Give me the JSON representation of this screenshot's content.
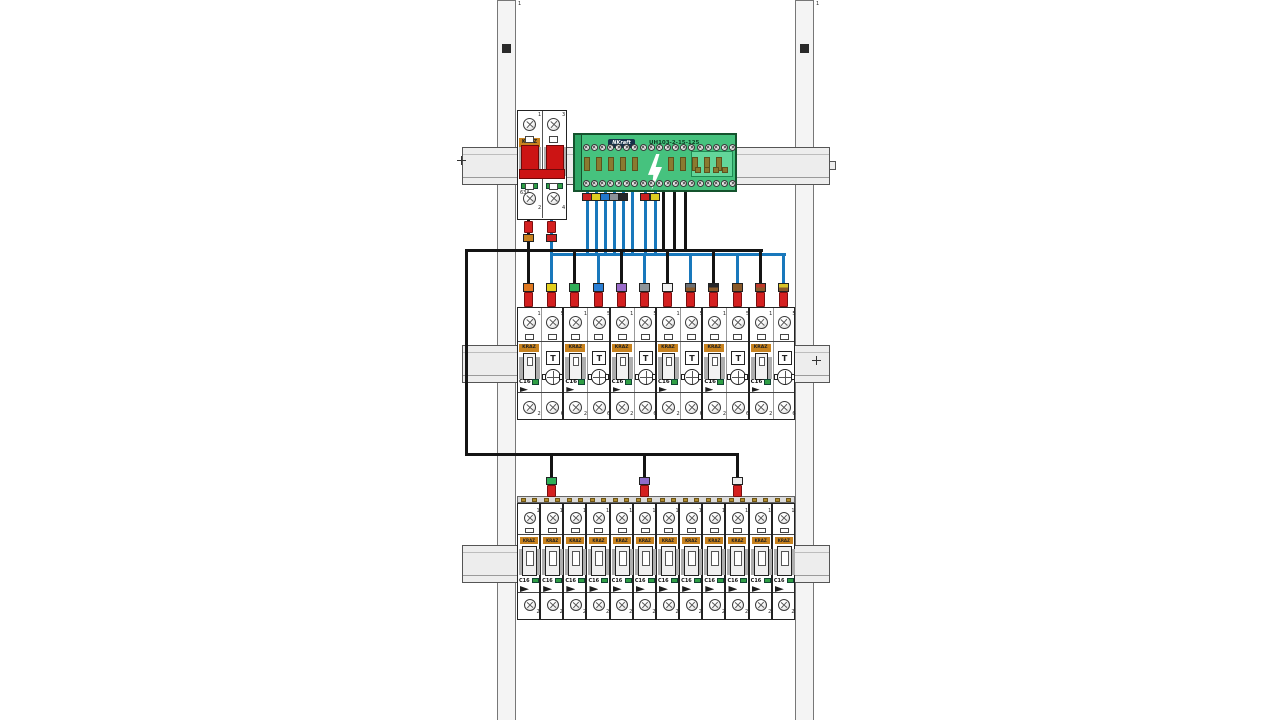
{
  "panel": {
    "left_rail_label": "1",
    "right_rail_label": "1"
  },
  "main_breaker": {
    "brand": "KRAZ",
    "rating": "63A",
    "top_terminal_numbers": [
      "1",
      "3"
    ],
    "bottom_terminal_numbers": [
      "2",
      "4"
    ],
    "output_wire_tag_colors": [
      "#c8821e",
      "#cc2222"
    ]
  },
  "terminal_block": {
    "brand": "NKraft",
    "model": "UH103-2-15-125",
    "output_tag_colors": [
      "#cc2222",
      "#ddcc22",
      "#2277cc",
      "#8d9399",
      "#26262a",
      "#cc2222",
      "#ddcc22"
    ]
  },
  "colors": {
    "wire_black": "#141414",
    "wire_blue": "#1878bc",
    "ferrule_red": "#d42020",
    "block_green": "#46c27e",
    "block_green_dark": "#2fa866",
    "logo_orange": "#c8821e",
    "indicator_green": "#2f9e44",
    "busbar_tooth": "#b08a2a"
  },
  "row1": {
    "unit_count": 6,
    "brand": "KRAZ",
    "rating": "C16",
    "test_button_label": "T",
    "top_terminal_numbers": [
      "1",
      "5"
    ],
    "bottom_terminal_numbers": [
      "2",
      "6"
    ],
    "terminal_tag_colors": [
      [
        "#e07820"
      ],
      [
        "#e3cf1e"
      ],
      [
        "#2fae57"
      ],
      [
        "#2b7fd4"
      ],
      [
        "#9a6bc9"
      ],
      [
        "#8d9399"
      ],
      [
        "#f0f0f0"
      ],
      [
        "#6b6f73",
        "#8a5a2a"
      ],
      [
        "#26262a",
        "#8a5a2a"
      ],
      [
        "#8a5a2a",
        "#8a5a2a"
      ],
      [
        "#c03a2a",
        "#8a5a2a"
      ],
      [
        "#d9c42a",
        "#8a5a2a"
      ]
    ]
  },
  "row2": {
    "unit_count": 12,
    "brand": "KRAZ",
    "rating": "C16",
    "top_terminal_number": "1",
    "bottom_terminal_number": "2",
    "feed_tag_colors": [
      "#2fae57",
      "#8f6cc9",
      "#ececec"
    ]
  }
}
